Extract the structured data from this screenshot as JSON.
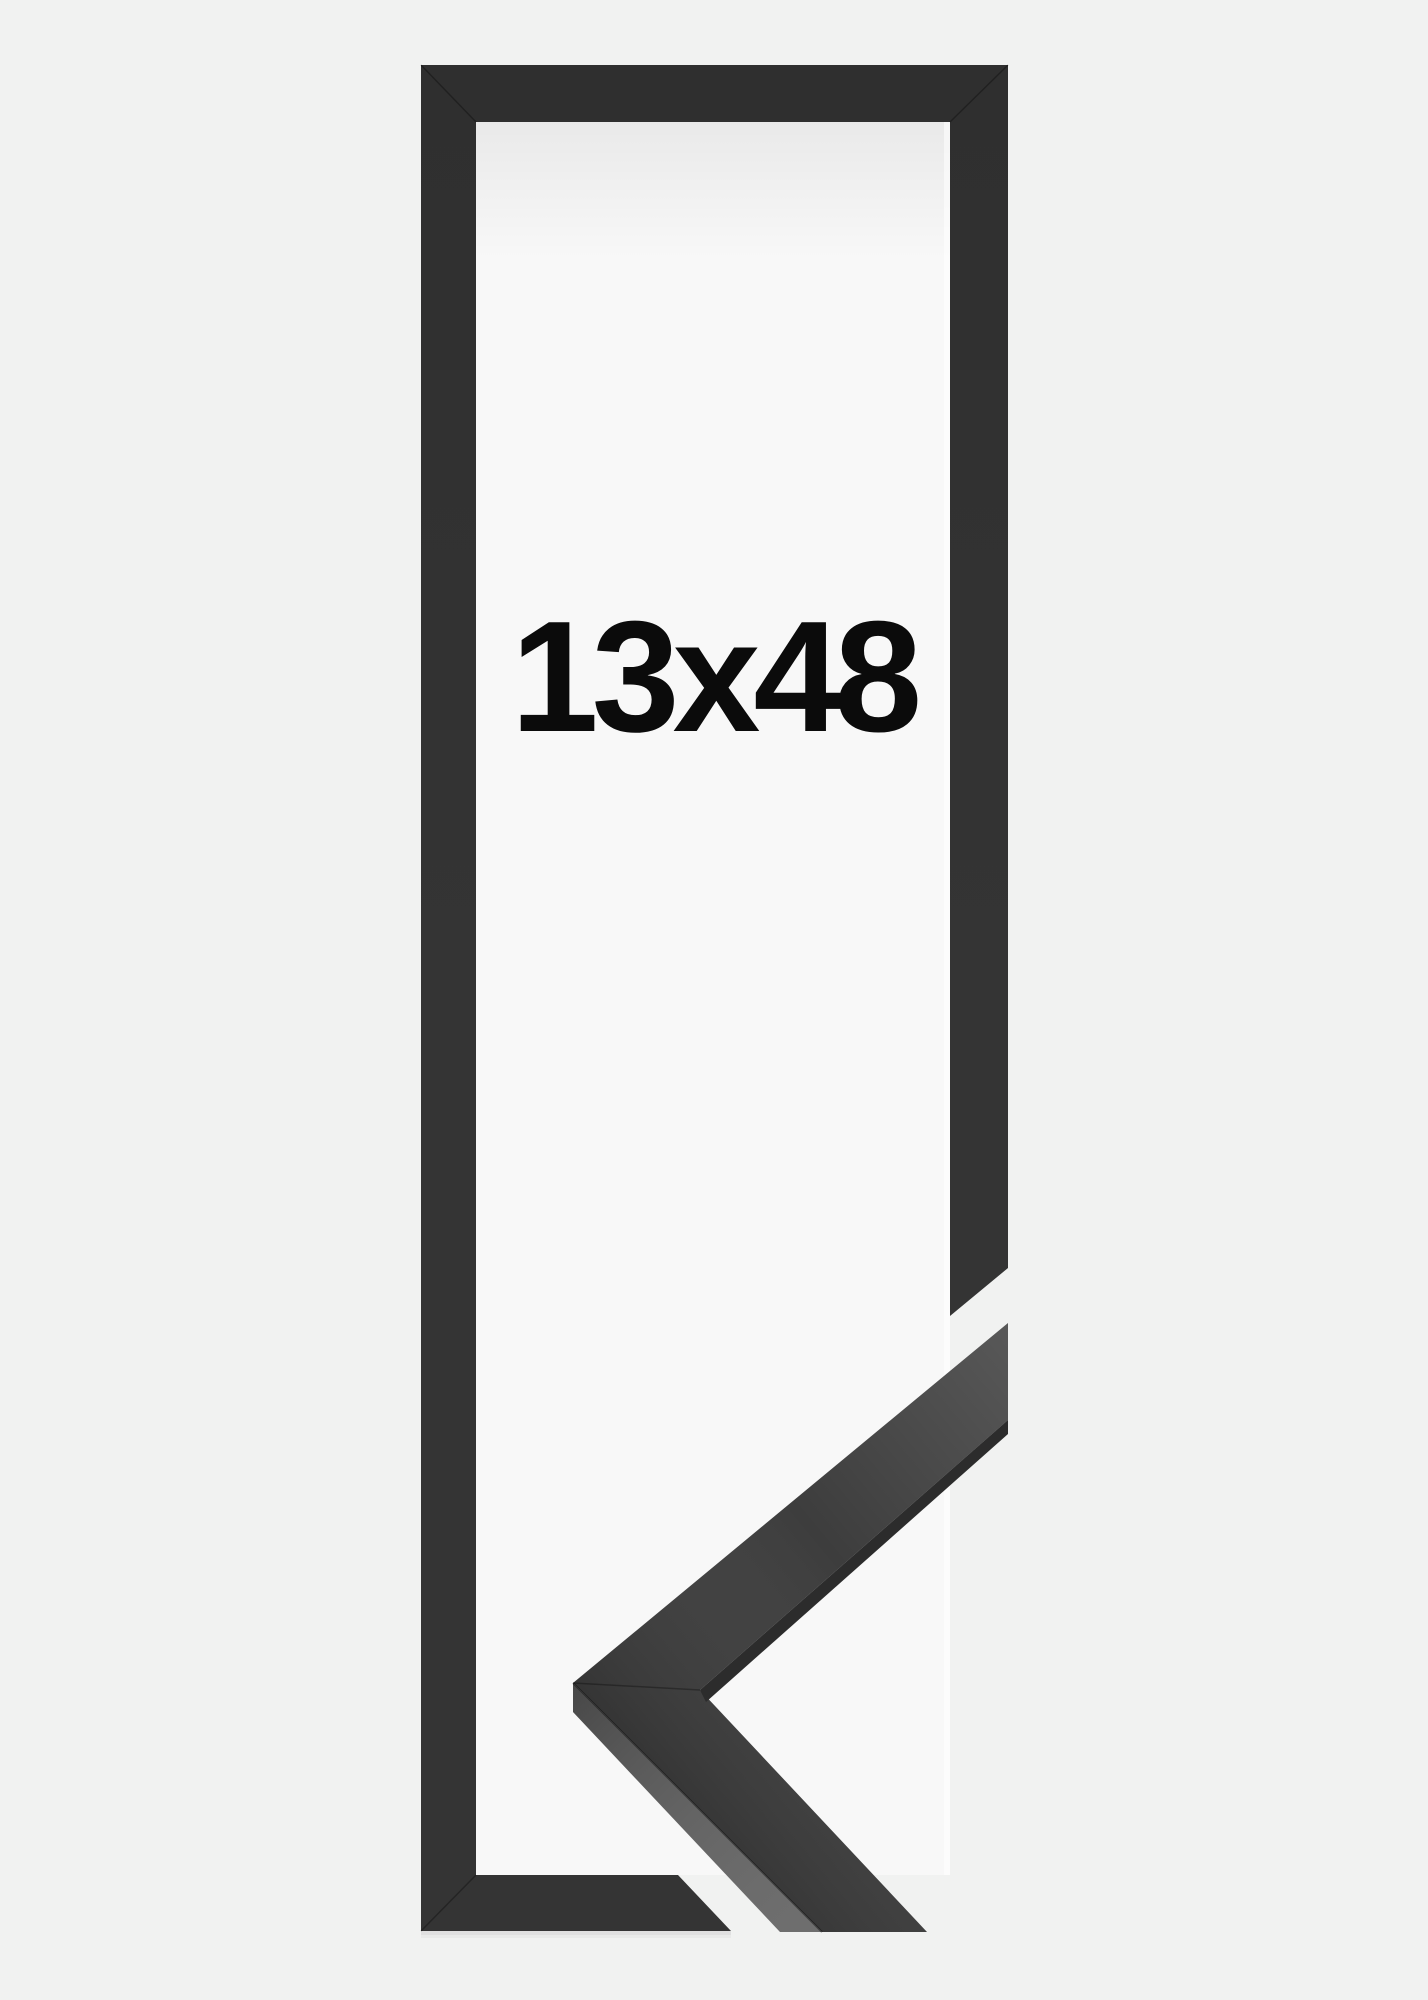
{
  "product": {
    "size_label": "13x48"
  },
  "colors": {
    "page_background": "#f1f2f1",
    "frame": "#343434",
    "frame_interior": "#f8f8f8",
    "moulding_face": "#3d3d3d",
    "moulding_side": "#5e5e5e",
    "moulding_edge": "#2c2c2c",
    "label_text": "#0b0b0b"
  }
}
